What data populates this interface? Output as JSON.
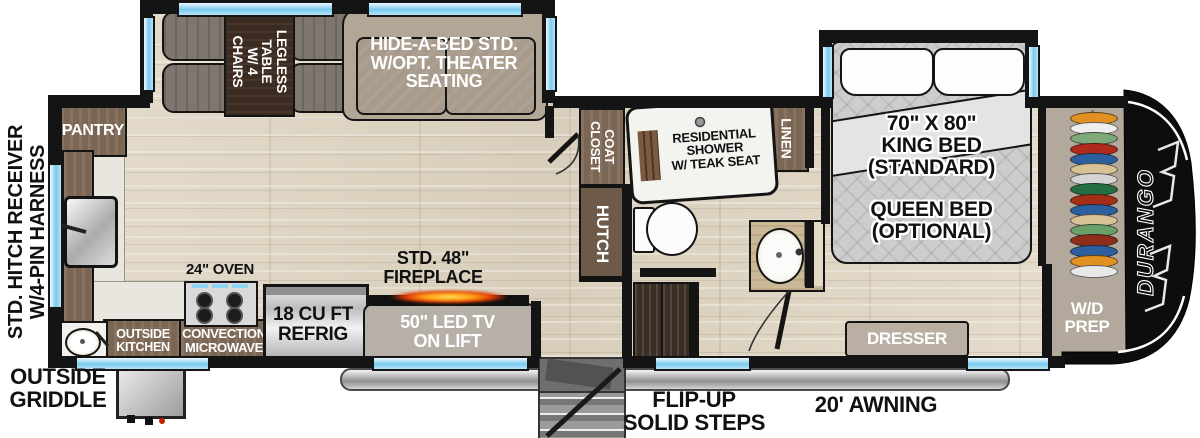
{
  "floorplan": {
    "brand": "DURANGO",
    "exterior": {
      "hitch_line1": "STD. HITCH RECEIVER",
      "hitch_line2": "W/4-PIN HARNESS",
      "griddle": "OUTSIDE\nGRIDDLE",
      "flip_steps": "FLIP-UP\nSOLID STEPS",
      "awning": "20' AWNING"
    },
    "kitchen": {
      "pantry": "PANTRY",
      "oven": "24\" OVEN",
      "outside_kitchen": "OUTSIDE\nKITCHEN",
      "microwave": "CONVECTION\nMICROWAVE",
      "fridge": "18 CU FT\nREFRIG"
    },
    "living": {
      "dinette": "LEGLESS\nTABLE\nW/ 4 CHAIRS",
      "sofa": "HIDE-A-BED STD.\nW/OPT. THEATER\nSEATING",
      "fireplace": "STD. 48\"\nFIREPLACE",
      "tv": "50\" LED TV\nON LIFT",
      "coat_closet": "COAT\nCLOSET",
      "hutch": "HUTCH"
    },
    "bath": {
      "shower": "RESIDENTIAL\nSHOWER\nW/ TEAK SEAT",
      "linen": "LINEN"
    },
    "bedroom": {
      "bed_primary": "70\" X 80\"\nKING BED\n(STANDARD)",
      "bed_optional": "QUEEN BED\n(OPTIONAL)",
      "dresser": "DRESSER",
      "wd_prep": "W/D\nPREP",
      "hanger_colors": [
        "#e09122",
        "#eeeeee",
        "#7fa87b",
        "#b02a1c",
        "#2d5f9e",
        "#d9c196",
        "#d4d4d4",
        "#256e42",
        "#a62e16",
        "#2d5f9e",
        "#d9c196",
        "#6aa06a",
        "#8e2e1a",
        "#2d5f9e",
        "#e09122",
        "#e8e8e8"
      ]
    },
    "colors": {
      "wall": "#141414",
      "window": "#7ac9ef",
      "wood": "#ded5c5",
      "cabinet": "#7b6553",
      "taupe": "#b2a89c",
      "flame": "#ff9b12"
    }
  }
}
